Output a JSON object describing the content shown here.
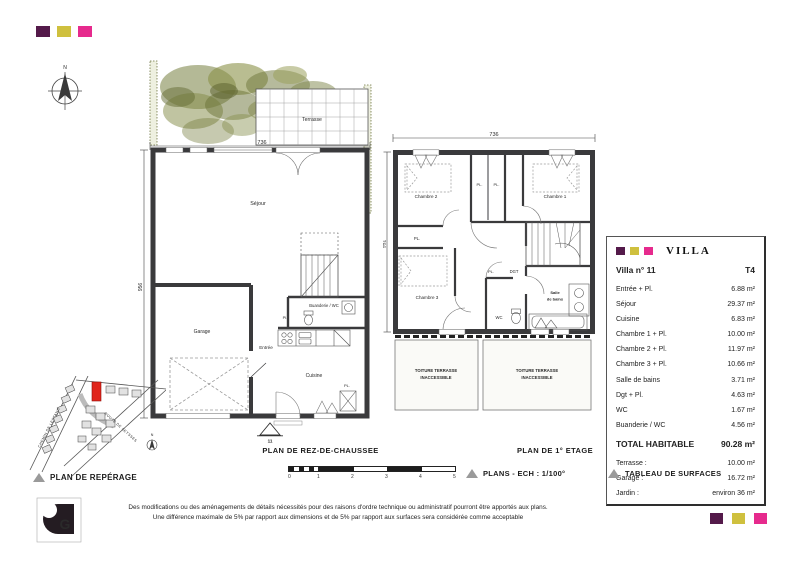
{
  "palette": {
    "purple": "#541a4a",
    "olive": "#cfc03e",
    "magenta": "#e62a8d",
    "wall": "#3a3a3c",
    "site_highlight_red": "#e0251c",
    "greenery_olive": "#77803f"
  },
  "north_indicator": "N",
  "ground_floor": {
    "title": "PLAN DE REZ-DE-CHAUSSEE",
    "marker_number": "11",
    "width_dim": "736",
    "height_dim": "956",
    "labels": {
      "terrasse": "Terrasse",
      "sejour": "Séjour",
      "garage": "Garage",
      "entree": "Entrée",
      "cuisine": "Cuisine",
      "buanderie": "Buanderie / WC",
      "pl_small": "Pl.",
      "pl": "PL."
    }
  },
  "first_floor": {
    "title": "PLAN DE 1° ETAGE",
    "width_dim": "736",
    "height_dim": "951",
    "labels": {
      "chambre1": "Chambre 1",
      "chambre2": "Chambre 2",
      "chambre3": "Chambre 3",
      "pl_a": "PL.",
      "pl_b": "PL.",
      "pl_c": "PL.",
      "pl_d": "PL.",
      "dgt": "DGT",
      "wc": "WC",
      "salle_line1": "Salle",
      "salle_line2": "de bains",
      "toiture_line1": "TOITURE TERRASSE",
      "toiture_line2": "INACCESSIBLE"
    }
  },
  "site_plan": {
    "street_left": "CHEMIN DE LESTANG",
    "street_right": "ROUTE DE SEYSSES",
    "north": "N"
  },
  "captions": {
    "reperage": "PLAN DE REPÉRAGE",
    "plans_scale": "PLANS - ECH : 1/100°",
    "surfaces": "TABLEAU DE SURFACES"
  },
  "scale_bar_ticks": [
    "0",
    "1",
    "2",
    "3",
    "4",
    "5"
  ],
  "surface_table": {
    "brand": "VILLA",
    "villa": "Villa n° 11",
    "type": "T4",
    "rows": [
      {
        "label": "Entrée + Pl.",
        "value": "6.88 m²"
      },
      {
        "label": "Séjour",
        "value": "29.37 m²"
      },
      {
        "label": "Cuisine",
        "value": "6.83 m²"
      },
      {
        "label": "Chambre 1 + Pl.",
        "value": "10.00 m²"
      },
      {
        "label": "Chambre 2 + Pl.",
        "value": "11.97 m²"
      },
      {
        "label": "Chambre 3 + Pl.",
        "value": "10.66 m²"
      },
      {
        "label": "Salle de bains",
        "value": "3.71 m²"
      },
      {
        "label": "Dgt + Pl.",
        "value": "4.63 m²"
      },
      {
        "label": "WC",
        "value": "1.67 m²"
      },
      {
        "label": "Buanderie / WC",
        "value": "4.56 m²"
      }
    ],
    "total_label": "TOTAL HABITABLE",
    "total_value": "90.28 m²",
    "extras": [
      {
        "label": "Terrasse :",
        "value": "10.00 m²"
      },
      {
        "label": "Garage :",
        "value": "16.72 m²"
      },
      {
        "label": "Jardin :",
        "value": "environ 36 m²"
      }
    ]
  },
  "disclaimer": {
    "line1": "Des modifications ou des aménagements de détails nécessités pour des raisons d'ordre technique ou administratif pourront être apportés aux plans.",
    "line2": "Une différence maximale de 5% par rapport aux dimensions et de 5% par rapport aux surfaces sera considérée comme acceptable"
  }
}
